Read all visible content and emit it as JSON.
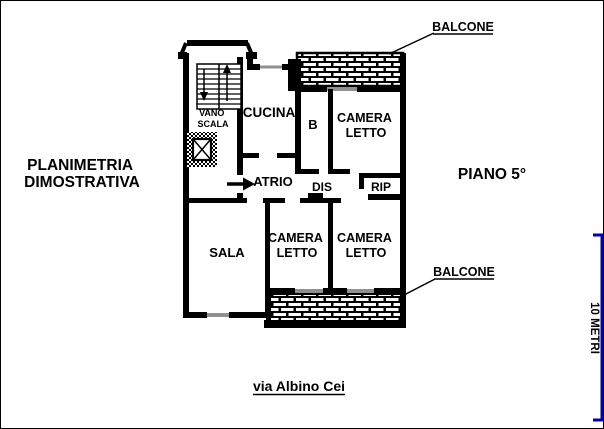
{
  "title": {
    "line1": "PLANIMETRIA",
    "line2": "DIMOSTRATIVA"
  },
  "floor_label": "PIANO 5°",
  "street_label": "via Albino Cei",
  "balcony_top_label": "BALCONE",
  "balcony_bottom_label": "BALCONE",
  "scale": {
    "label": "10 METRI",
    "color": "#0000AC"
  },
  "rooms": {
    "vano_scala": {
      "line1": "VANO",
      "line2": "SCALA"
    },
    "cucina": "CUCINA",
    "bagno": "B",
    "camera_letto_top": {
      "line1": "CAMERA",
      "line2": "LETTO"
    },
    "atrio": "ATRIO",
    "disimpegno": "DIS",
    "ripostiglio": "RIP",
    "sala": "SALA",
    "camera_letto_bottom_left": {
      "line1": "CAMERA",
      "line2": "LETTO"
    },
    "camera_letto_bottom_right": {
      "line1": "CAMERA",
      "line2": "LETTO"
    }
  },
  "colors": {
    "plan": "#000000",
    "window": "#909090",
    "background": "#ffffff"
  }
}
